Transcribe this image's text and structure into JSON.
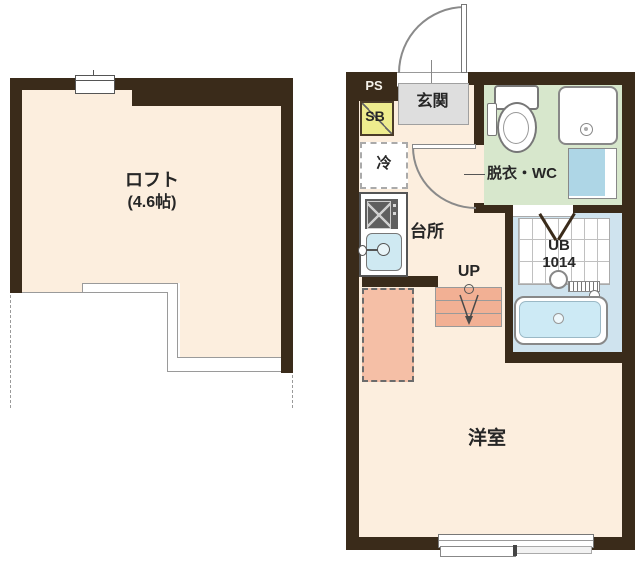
{
  "loft_plan": {
    "room_label": "ロフト",
    "room_size_label": "(4.6帖)"
  },
  "main_plan": {
    "entrance_label": "玄関",
    "pipe_space_label": "PS",
    "shoe_box_label": "SB",
    "refrigerator_label": "冷",
    "kitchen_label": "台所",
    "dressing_wc_label": "脱衣・WC",
    "unit_bath_label": "UB",
    "unit_bath_size_label": "1014",
    "stairs_label": "UP",
    "main_room_label": "洋室"
  },
  "colors": {
    "wall_dark_brown": "#3a2b1a",
    "floor_cream": "#fceede",
    "dressing_room_green": "#d7e7cc",
    "unit_bath_blue": "#cfe3ee",
    "bathtub_blue": "#cdeaf5",
    "stairs_salmon": "#f2b094",
    "loft_overhang_salmon": "#f5bfa6",
    "shoe_box_yellow": "#eeec8e",
    "entrance_mat_gray": "#dedede",
    "kitchen_sink_blue": "#cfe9f2",
    "washbasin_blue": "#aed6e6",
    "outline_gray": "#9a9a9a"
  }
}
